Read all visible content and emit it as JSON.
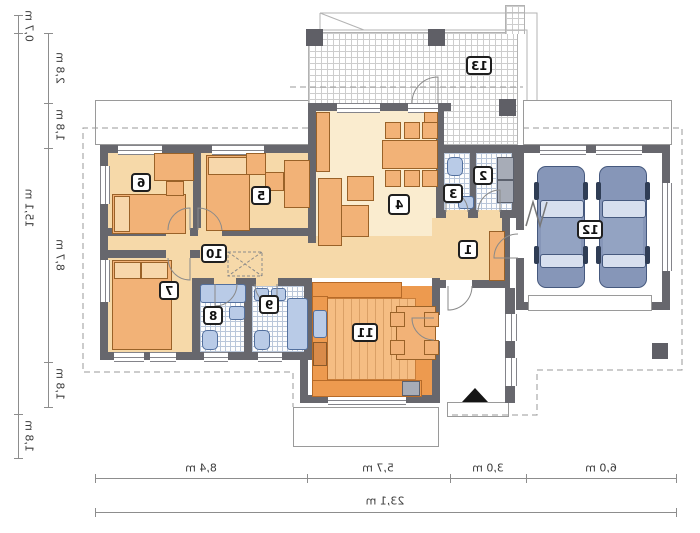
{
  "plan_type": "house-floor-plan-mirrored",
  "rooms": [
    {
      "number": "1",
      "name": "hall"
    },
    {
      "number": "2",
      "name": "utility-room"
    },
    {
      "number": "3",
      "name": "wc"
    },
    {
      "number": "4",
      "name": "living-room"
    },
    {
      "number": "5",
      "name": "bedroom"
    },
    {
      "number": "6",
      "name": "bedroom"
    },
    {
      "number": "7",
      "name": "bedroom"
    },
    {
      "number": "8",
      "name": "bathroom"
    },
    {
      "number": "9",
      "name": "bathroom"
    },
    {
      "number": "10",
      "name": "corridor"
    },
    {
      "number": "11",
      "name": "kitchen"
    },
    {
      "number": "12",
      "name": "garage"
    },
    {
      "number": "13",
      "name": "terrace"
    }
  ],
  "dimensions": {
    "left_outer": [
      {
        "label": "0,7 m"
      },
      {
        "label": "15,1 m"
      },
      {
        "label": "1,8 m"
      }
    ],
    "left_inner": [
      {
        "label": "2,8 m"
      },
      {
        "label": "1,8 m"
      },
      {
        "label": "8,7 m"
      },
      {
        "label": "1,8 m"
      }
    ],
    "bottom_segments": [
      {
        "label": "8,4 m"
      },
      {
        "label": "5,7 m"
      },
      {
        "label": "3,0 m"
      },
      {
        "label": "6,0 m"
      }
    ],
    "bottom_total": "23,1 m"
  },
  "colors": {
    "wall": "#67676d",
    "bedroom_floor": "#f6d9a9",
    "living_floor": "#faeccf",
    "kitchen_floor": "#f5bd83",
    "fixture_blue": "#b9cbe7",
    "furniture_orange": "#f2b277",
    "car_body": "#8696b8"
  }
}
